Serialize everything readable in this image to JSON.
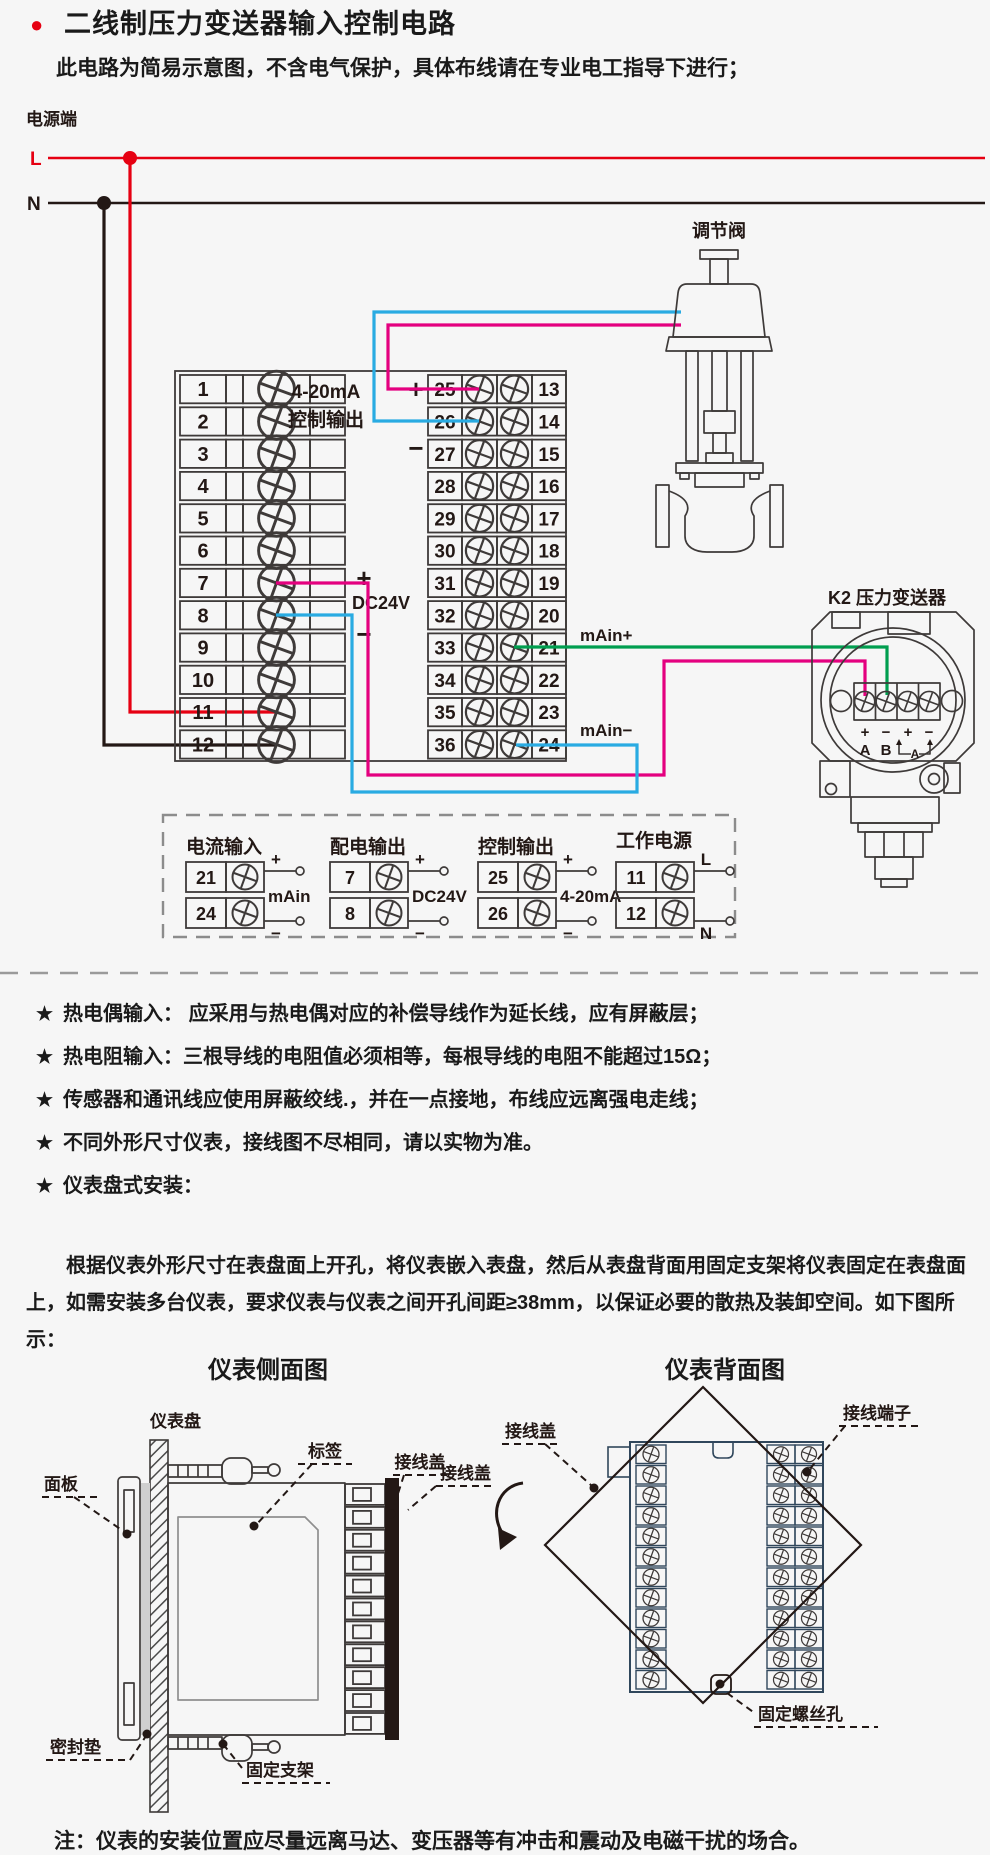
{
  "header": {
    "title": "二线制压力变送器输入控制电路",
    "subtitle": "此电路为简易示意图，不含电气保护，具体布线请在专业电工指导下进行；"
  },
  "circuit": {
    "power_label": "电源端",
    "l": "L",
    "n": "N",
    "output_line1": "4-20mA",
    "output_line2": "控制输出",
    "plus": "+",
    "minus": "−",
    "dc24v": "DC24V",
    "main_plus": "mAin+",
    "main_minus": "mAin−",
    "valve_label": "调节阀",
    "transmitter_label": "K2 压力变送器",
    "tx_pin_a": "A",
    "tx_pin_b": "B",
    "tx_meter": "A",
    "left_terminals": [
      "1",
      "2",
      "3",
      "4",
      "5",
      "6",
      "7",
      "8",
      "9",
      "10",
      "11",
      "12"
    ],
    "right_terminals_left": [
      "25",
      "26",
      "27",
      "28",
      "29",
      "30",
      "31",
      "32",
      "33",
      "34",
      "35",
      "36"
    ],
    "right_terminals_right": [
      "13",
      "14",
      "15",
      "16",
      "17",
      "18",
      "19",
      "20",
      "21",
      "22",
      "23",
      "24"
    ],
    "colors": {
      "live": "#e60012",
      "neutral": "#231815",
      "loop_plus": "#e4007f",
      "loop_minus": "#29abe2",
      "signal": "#009e4f"
    }
  },
  "legend": {
    "groups": [
      {
        "title": "电流输入",
        "rows": [
          {
            "no": "21",
            "sign": "+"
          },
          {
            "no": "24",
            "sign": "−"
          }
        ],
        "label": "mAin"
      },
      {
        "title": "配电输出",
        "rows": [
          {
            "no": "7",
            "sign": "+"
          },
          {
            "no": "8",
            "sign": "−"
          }
        ],
        "label": "DC24V"
      },
      {
        "title": "控制输出",
        "rows": [
          {
            "no": "25",
            "sign": "+"
          },
          {
            "no": "26",
            "sign": "−"
          }
        ],
        "label": "4-20mA"
      },
      {
        "title": "工作电源",
        "rows": [
          {
            "no": "11",
            "sign": "L"
          },
          {
            "no": "12",
            "sign": "N"
          }
        ],
        "label": ""
      }
    ]
  },
  "notes": {
    "star": "★",
    "items": [
      "热电偶输入： 应采用与热电偶对应的补偿导线作为延长线，应有屏蔽层；",
      "热电阻输入：三根导线的电阻值必须相等，每根导线的电阻不能超过15Ω；",
      "传感器和通讯线应使用屏蔽绞线.，并在一点接地，布线应远离强电走线；",
      "不同外形尺寸仪表，接线图不尽相同，请以实物为准。",
      "仪表盘式安装："
    ]
  },
  "install": {
    "paragraph": "根据仪表外形尺寸在表盘面上开孔，将仪表嵌入表盘，然后从表盘背面用固定支架将仪表固定在表盘面上，如需安装多台仪表，要求仪表与仪表之间开孔间距≥38mm，以保证必要的散热及装卸空间。如下图所示："
  },
  "figures": {
    "side_title": "仪表侧面图",
    "back_title": "仪表背面图",
    "side_labels": {
      "panel_board": "仪表盘",
      "front_panel": "面板",
      "tag": "标签",
      "cover": "接线盖",
      "gasket": "密封垫",
      "bracket": "固定支架"
    },
    "back_labels": {
      "cover1": "接线盖",
      "cover2": "接线盖",
      "terminal": "接线端子",
      "screw_hole": "固定螺丝孔"
    }
  },
  "footnote": "注：仪表的安装位置应尽量远离马达、变压器等有冲击和震动及电磁干扰的场合。"
}
